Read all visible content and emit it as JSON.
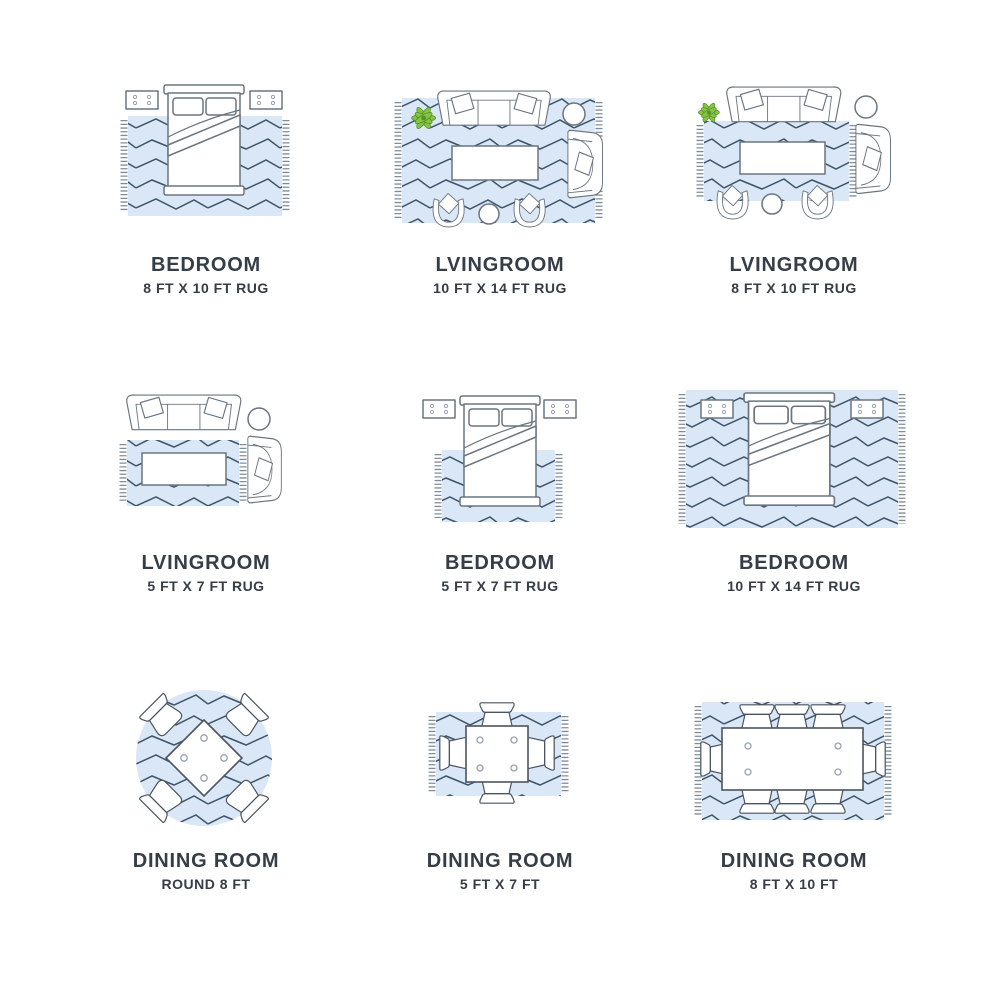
{
  "colors": {
    "background": "#ffffff",
    "rug": "#d9e7f6",
    "zigzag": "#3e5468",
    "fringe": "#5d7183",
    "furniture_stroke": "#6a7580",
    "dining_stroke": "#4a545e",
    "plant_fill": "#85c440",
    "plant_stroke": "#55902b",
    "label": "#353d47"
  },
  "cells": [
    {
      "room": "BEDROOM",
      "size": "8 FT X 10 FT RUG"
    },
    {
      "room": "LVINGROOM",
      "size": "10 FT X 14 FT RUG"
    },
    {
      "room": "LVINGROOM",
      "size": "8 FT X 10 FT RUG"
    },
    {
      "room": "LVINGROOM",
      "size": "5 FT X 7 FT RUG"
    },
    {
      "room": "BEDROOM",
      "size": "5 FT X 7 FT RUG"
    },
    {
      "room": "BEDROOM",
      "size": "10 FT X 14 FT RUG"
    },
    {
      "room": "DINING ROOM",
      "size": "ROUND 8 FT"
    },
    {
      "room": "DINING ROOM",
      "size": "5 FT X 7 FT"
    },
    {
      "room": "DINING ROOM",
      "size": "8 FT X 10 FT"
    }
  ]
}
